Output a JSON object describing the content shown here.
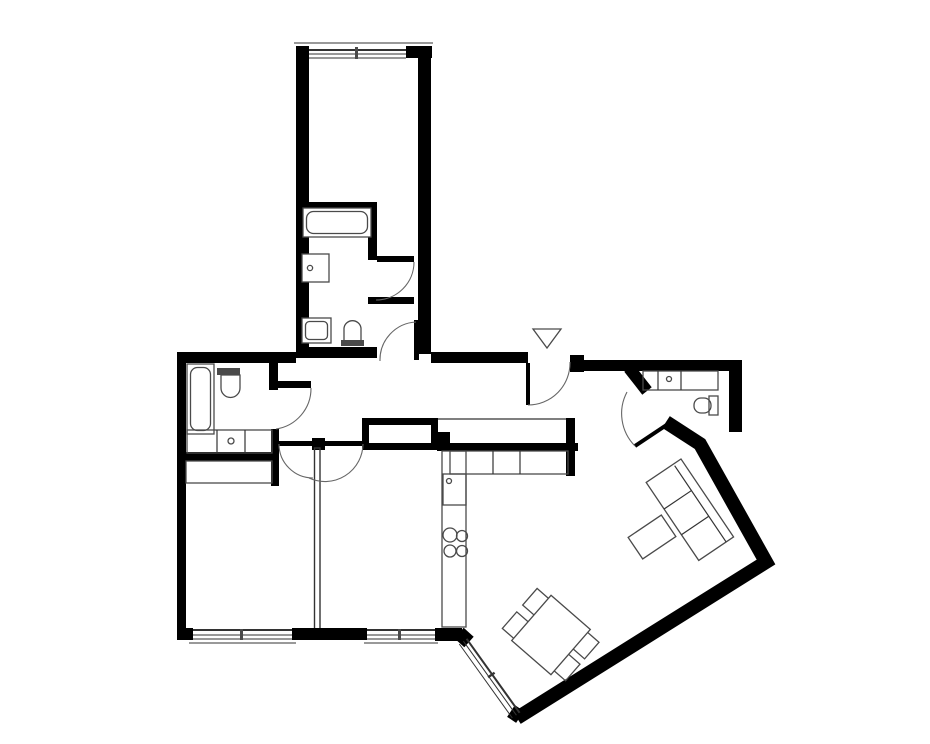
{
  "title": "Apartment floor plan drawing",
  "colors": {
    "walls": "#000000",
    "fixtures": "#4a4a4a",
    "thin": "#333333",
    "arc": "#666666",
    "background": "#ffffff"
  },
  "entrance": {
    "marker": "triangle-arrow-down"
  },
  "rooms": [
    {
      "id": "top-room",
      "name": "top room",
      "fixtures": [
        "window"
      ]
    },
    {
      "id": "top-room-bathroom",
      "name": "en-suite bathroom",
      "fixtures": [
        "bathtub",
        "washing-machine",
        "sink",
        "toilet"
      ]
    },
    {
      "id": "left-bathroom",
      "name": "left bathroom",
      "fixtures": [
        "bathtub",
        "toilet",
        "cabinet-row",
        "washing-machine"
      ]
    },
    {
      "id": "bedroom-left",
      "name": "bottom left room",
      "fixtures": [
        "wardrobe",
        "window"
      ]
    },
    {
      "id": "bedroom-right",
      "name": "bottom middle room",
      "fixtures": [
        "window"
      ]
    },
    {
      "id": "hallway",
      "name": "hallway",
      "fixtures": [
        "entrance-door"
      ]
    },
    {
      "id": "kitchen",
      "name": "kitchen",
      "fixtures": [
        "counter",
        "sink",
        "stove-burners",
        "cabinets"
      ]
    },
    {
      "id": "right-bathroom",
      "name": "small bathroom",
      "fixtures": [
        "vanity-sink",
        "toilet"
      ]
    },
    {
      "id": "living-dining",
      "name": "living and dining area",
      "fixtures": [
        "sofa",
        "coffee-table",
        "dining-table",
        "chairs",
        "corner-window"
      ]
    }
  ],
  "doors": {
    "count": 8,
    "style": "quarter-circle swing arcs"
  },
  "windows": {
    "count": 4
  }
}
